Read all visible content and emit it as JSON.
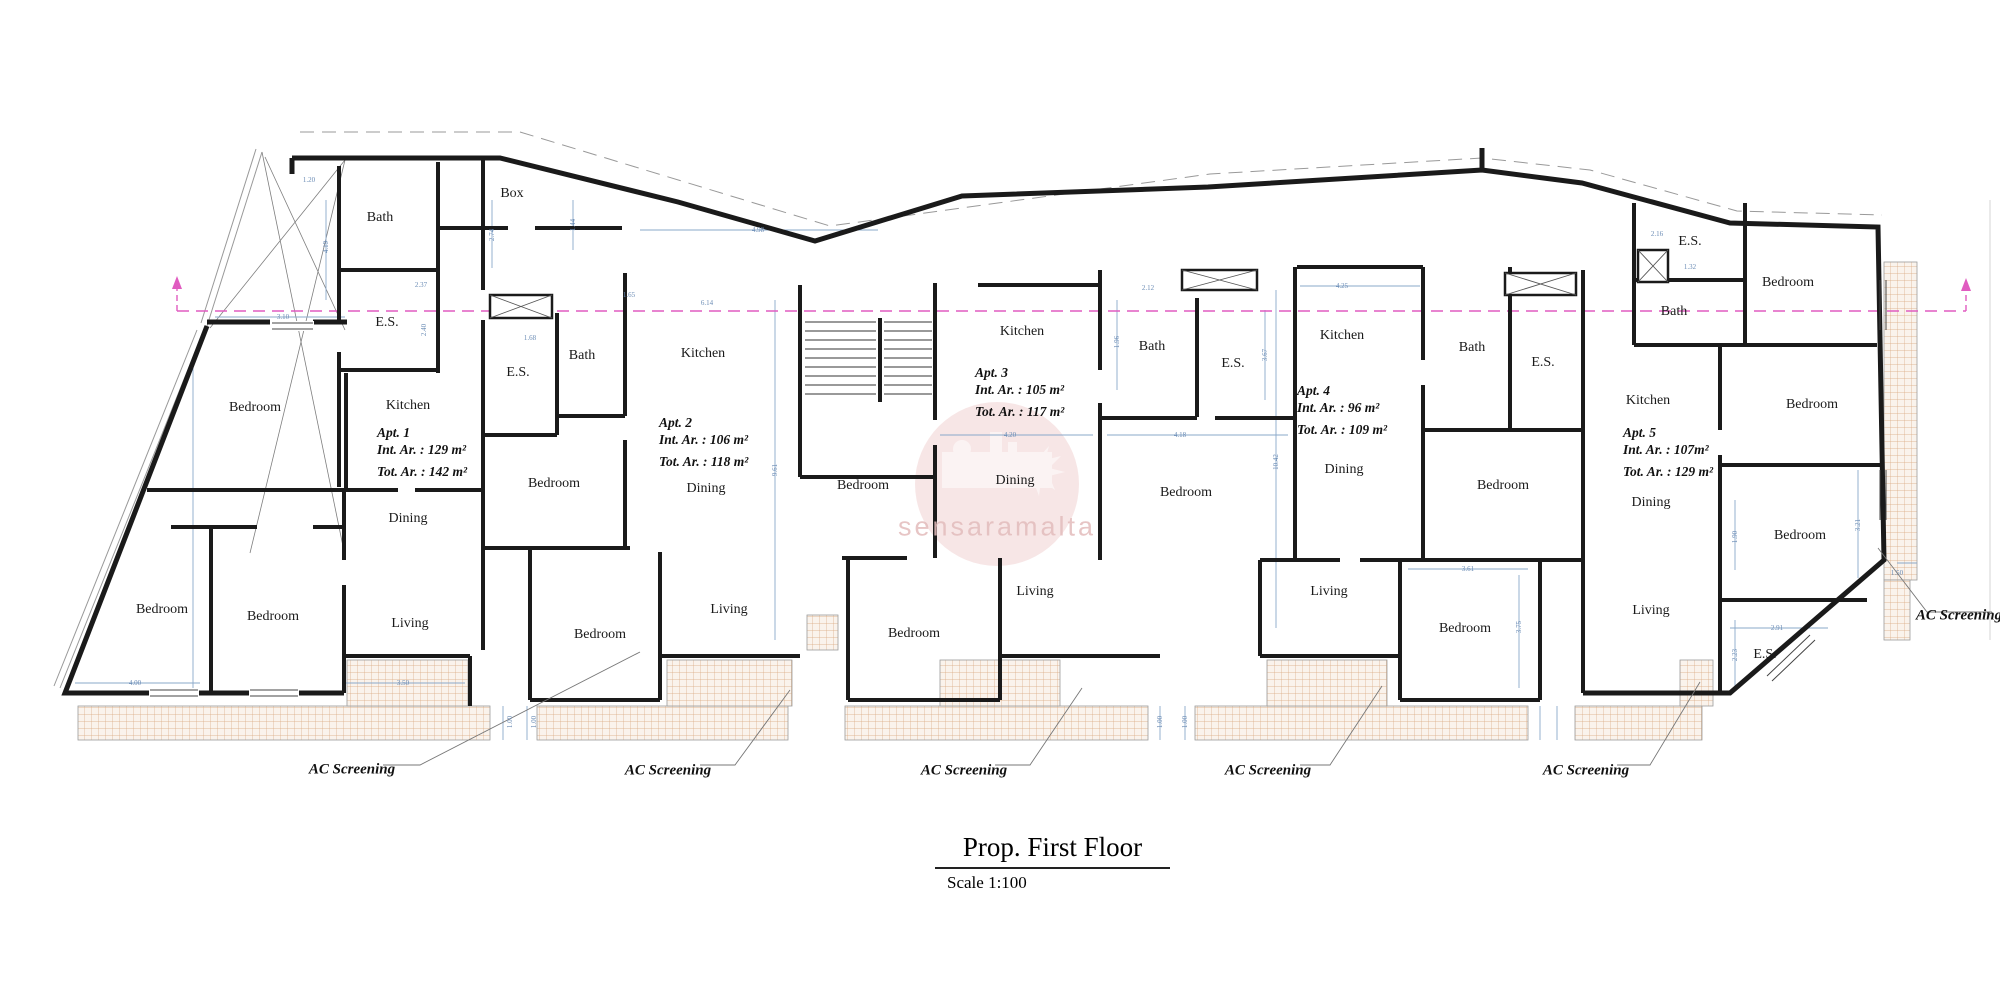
{
  "title_block": {
    "title": "Prop. First Floor",
    "scale": "Scale 1:100"
  },
  "watermark": {
    "text": "sensaramalta",
    "color": "#d98f8f"
  },
  "colors": {
    "walls": "#1a1a1a",
    "dimension_lines": "#8aa8ca",
    "section_line": "#e05cc0",
    "hatch_line": "#d8a87e",
    "hatch_fill": "#faf3ec"
  },
  "rooms": [
    {
      "label": "Bath",
      "x": 380,
      "y": 218
    },
    {
      "label": "Box",
      "x": 512,
      "y": 194
    },
    {
      "label": "E.S.",
      "x": 387,
      "y": 323
    },
    {
      "label": "Bedroom",
      "x": 255,
      "y": 408
    },
    {
      "label": "Kitchen",
      "x": 408,
      "y": 406
    },
    {
      "label": "Dining",
      "x": 408,
      "y": 519
    },
    {
      "label": "Bedroom",
      "x": 162,
      "y": 610
    },
    {
      "label": "Bedroom",
      "x": 273,
      "y": 617
    },
    {
      "label": "Living",
      "x": 410,
      "y": 624
    },
    {
      "label": "E.S.",
      "x": 518,
      "y": 373
    },
    {
      "label": "Bath",
      "x": 582,
      "y": 356
    },
    {
      "label": "Kitchen",
      "x": 703,
      "y": 354
    },
    {
      "label": "Bedroom",
      "x": 554,
      "y": 484
    },
    {
      "label": "Dining",
      "x": 706,
      "y": 489
    },
    {
      "label": "Bedroom",
      "x": 600,
      "y": 635
    },
    {
      "label": "Living",
      "x": 729,
      "y": 610
    },
    {
      "label": "Kitchen",
      "x": 1022,
      "y": 332
    },
    {
      "label": "Bath",
      "x": 1152,
      "y": 347
    },
    {
      "label": "E.S.",
      "x": 1233,
      "y": 364
    },
    {
      "label": "Bedroom",
      "x": 863,
      "y": 486
    },
    {
      "label": "Dining",
      "x": 1015,
      "y": 481
    },
    {
      "label": "Bedroom",
      "x": 1186,
      "y": 493
    },
    {
      "label": "Bedroom",
      "x": 914,
      "y": 634
    },
    {
      "label": "Living",
      "x": 1035,
      "y": 592
    },
    {
      "label": "Kitchen",
      "x": 1342,
      "y": 336
    },
    {
      "label": "Bath",
      "x": 1472,
      "y": 348
    },
    {
      "label": "E.S.",
      "x": 1543,
      "y": 363
    },
    {
      "label": "Dining",
      "x": 1344,
      "y": 470
    },
    {
      "label": "Bedroom",
      "x": 1503,
      "y": 486
    },
    {
      "label": "Living",
      "x": 1329,
      "y": 592
    },
    {
      "label": "Bedroom",
      "x": 1465,
      "y": 629
    },
    {
      "label": "E.S.",
      "x": 1690,
      "y": 242
    },
    {
      "label": "Bedroom",
      "x": 1788,
      "y": 283
    },
    {
      "label": "Bath",
      "x": 1674,
      "y": 312
    },
    {
      "label": "Kitchen",
      "x": 1648,
      "y": 401
    },
    {
      "label": "Bedroom",
      "x": 1812,
      "y": 405
    },
    {
      "label": "Dining",
      "x": 1651,
      "y": 503
    },
    {
      "label": "Living",
      "x": 1651,
      "y": 611
    },
    {
      "label": "Bedroom",
      "x": 1800,
      "y": 536
    },
    {
      "label": "E.S.",
      "x": 1765,
      "y": 655
    }
  ],
  "apartments": [
    {
      "name": "Apt. 1",
      "int": "Int. Ar. : 129 m²",
      "tot": "Tot. Ar. : 142 m²",
      "x": 377,
      "y": 424
    },
    {
      "name": "Apt. 2",
      "int": "Int. Ar. : 106 m²",
      "tot": "Tot. Ar. : 118 m²",
      "x": 659,
      "y": 414
    },
    {
      "name": "Apt. 3",
      "int": "Int. Ar. : 105 m²",
      "tot": "Tot. Ar. : 117 m²",
      "x": 975,
      "y": 364
    },
    {
      "name": "Apt. 4",
      "int": "Int. Ar. : 96 m²",
      "tot": "Tot. Ar. : 109 m²",
      "x": 1297,
      "y": 382
    },
    {
      "name": "Apt. 5",
      "int": "Int. Ar. : 107m²",
      "tot": "Tot. Ar. : 129 m²",
      "x": 1623,
      "y": 424
    }
  ],
  "ac_labels": [
    {
      "text": "AC Screening",
      "x": 352,
      "y": 770
    },
    {
      "text": "AC Screening",
      "x": 668,
      "y": 771
    },
    {
      "text": "AC Screening",
      "x": 964,
      "y": 771
    },
    {
      "text": "AC Screening",
      "x": 1268,
      "y": 771
    },
    {
      "text": "AC Screening",
      "x": 1586,
      "y": 771
    },
    {
      "text": "AC Screening",
      "x": 1959,
      "y": 616
    }
  ],
  "dims": [
    {
      "t": "1.20",
      "x": 309,
      "y": 180
    },
    {
      "t": "4.19",
      "x": 326,
      "y": 247,
      "v": 1
    },
    {
      "t": "3.10",
      "x": 283,
      "y": 317
    },
    {
      "t": "2.37",
      "x": 421,
      "y": 285
    },
    {
      "t": "2.40",
      "x": 424,
      "y": 330,
      "v": 1
    },
    {
      "t": "2.74",
      "x": 492,
      "y": 235,
      "v": 1
    },
    {
      "t": "1.44",
      "x": 573,
      "y": 225,
      "v": 1
    },
    {
      "t": "4.98",
      "x": 758,
      "y": 230
    },
    {
      "t": "1.65",
      "x": 629,
      "y": 295
    },
    {
      "t": "1.68",
      "x": 530,
      "y": 338
    },
    {
      "t": "6.14",
      "x": 707,
      "y": 303
    },
    {
      "t": "9.61",
      "x": 775,
      "y": 470,
      "v": 1
    },
    {
      "t": "4.20",
      "x": 1010,
      "y": 435
    },
    {
      "t": "4.18",
      "x": 1180,
      "y": 435
    },
    {
      "t": "2.12",
      "x": 1148,
      "y": 288
    },
    {
      "t": "1.96",
      "x": 1117,
      "y": 342,
      "v": 1
    },
    {
      "t": "3.67",
      "x": 1265,
      "y": 355,
      "v": 1
    },
    {
      "t": "10.42",
      "x": 1276,
      "y": 462,
      "v": 1
    },
    {
      "t": "4.25",
      "x": 1342,
      "y": 286
    },
    {
      "t": "3.61",
      "x": 1468,
      "y": 569
    },
    {
      "t": "3.75",
      "x": 1519,
      "y": 627,
      "v": 1
    },
    {
      "t": "2.16",
      "x": 1657,
      "y": 234
    },
    {
      "t": "1.32",
      "x": 1690,
      "y": 267
    },
    {
      "t": "1.90",
      "x": 1735,
      "y": 537,
      "v": 1
    },
    {
      "t": "3.21",
      "x": 1858,
      "y": 525,
      "v": 1
    },
    {
      "t": "2.91",
      "x": 1777,
      "y": 628
    },
    {
      "t": "2.23",
      "x": 1735,
      "y": 655,
      "v": 1
    },
    {
      "t": "1.50",
      "x": 1897,
      "y": 573
    },
    {
      "t": "1.00",
      "x": 510,
      "y": 722,
      "v": 1
    },
    {
      "t": "1.00",
      "x": 534,
      "y": 722,
      "v": 1
    },
    {
      "t": "1.00",
      "x": 1160,
      "y": 722,
      "v": 1
    },
    {
      "t": "1.00",
      "x": 1185,
      "y": 722,
      "v": 1
    },
    {
      "t": "4.00",
      "x": 135,
      "y": 683
    },
    {
      "t": "3.50",
      "x": 403,
      "y": 683
    }
  ]
}
